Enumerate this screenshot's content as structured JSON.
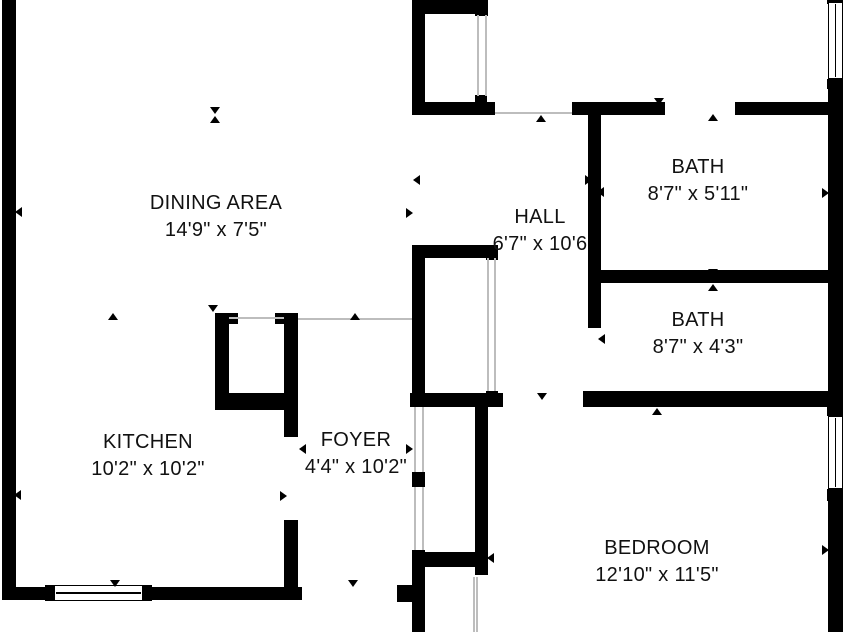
{
  "title": "Apartment floor plan",
  "colors": {
    "wall": "#000000",
    "opening_line": "#bdbdbd",
    "background": "#ffffff",
    "text": "#111111"
  },
  "rooms": [
    {
      "id": "dining",
      "name": "DINING AREA",
      "dims": "14'9\" x 7'5\"",
      "cx": 216,
      "cy": 217
    },
    {
      "id": "kitchen",
      "name": "KITCHEN",
      "dims": "10'2\" x 10'2\"",
      "cx": 148,
      "cy": 456
    },
    {
      "id": "foyer",
      "name": "FOYER",
      "dims": "4'4\" x 10'2\"",
      "cx": 356,
      "cy": 454
    },
    {
      "id": "hall",
      "name": "HALL",
      "dims": "6'7\" x 10'6",
      "cx": 540,
      "cy": 231
    },
    {
      "id": "bath-upper",
      "name": "BATH",
      "dims": "8'7\" x 5'11\"",
      "cx": 698,
      "cy": 181
    },
    {
      "id": "bath-lower",
      "name": "BATH",
      "dims": "8'7\" x 4'3\"",
      "cx": 698,
      "cy": 334
    },
    {
      "id": "bedroom",
      "name": "BEDROOM",
      "dims": "12'10\" x 11'5\"",
      "cx": 657,
      "cy": 562
    }
  ],
  "walls": [
    [
      2,
      0,
      14,
      600
    ],
    [
      2,
      587,
      300,
      13
    ],
    [
      412,
      0,
      76,
      14
    ],
    [
      412,
      0,
      13,
      115
    ],
    [
      412,
      102,
      83,
      13
    ],
    [
      475,
      0,
      13,
      16
    ],
    [
      475,
      95,
      12,
      8
    ],
    [
      572,
      102,
      93,
      13
    ],
    [
      735,
      102,
      93,
      13
    ],
    [
      828,
      0,
      15,
      632
    ],
    [
      588,
      115,
      13,
      213
    ],
    [
      600,
      270,
      228,
      13
    ],
    [
      583,
      391,
      245,
      16
    ],
    [
      410,
      393,
      93,
      14
    ],
    [
      412,
      245,
      86,
      13
    ],
    [
      412,
      245,
      13,
      162
    ],
    [
      486,
      245,
      12,
      15
    ],
    [
      486,
      391,
      12,
      16
    ],
    [
      215,
      313,
      14,
      97
    ],
    [
      229,
      313,
      9,
      11
    ],
    [
      275,
      313,
      9,
      11
    ],
    [
      284,
      313,
      14,
      124
    ],
    [
      215,
      393,
      83,
      17
    ],
    [
      284,
      520,
      14,
      67
    ],
    [
      412,
      472,
      13,
      15
    ],
    [
      412,
      550,
      13,
      82
    ],
    [
      425,
      552,
      52,
      15
    ],
    [
      397,
      585,
      15,
      17
    ],
    [
      475,
      400,
      13,
      175
    ]
  ],
  "opening_lines": [
    [
      229,
      317,
      55,
      2
    ],
    [
      298,
      318,
      114,
      2
    ],
    [
      495,
      112,
      77,
      2
    ],
    [
      477,
      15,
      2,
      81
    ],
    [
      485,
      15,
      2,
      81
    ],
    [
      487,
      258,
      2,
      133
    ],
    [
      494,
      258,
      2,
      133
    ],
    [
      414,
      407,
      2,
      65
    ],
    [
      422,
      407,
      2,
      65
    ],
    [
      414,
      487,
      2,
      63
    ],
    [
      422,
      487,
      2,
      63
    ],
    [
      473,
      577,
      2,
      55
    ],
    [
      476,
      577,
      2,
      55
    ]
  ],
  "windows": [
    {
      "orient": "h",
      "x": 54,
      "y": 585,
      "w": 89,
      "h": 16,
      "caps": [
        [
          45,
          585,
          9,
          16
        ],
        [
          143,
          585,
          9,
          16
        ]
      ]
    },
    {
      "orient": "v",
      "x": 828,
      "y": 2,
      "w": 15,
      "h": 77,
      "caps": [
        [
          827,
          0,
          16,
          4
        ],
        [
          827,
          79,
          16,
          10
        ]
      ]
    },
    {
      "orient": "v",
      "x": 828,
      "y": 416,
      "w": 15,
      "h": 73,
      "caps": [
        [
          827,
          405,
          16,
          11
        ],
        [
          827,
          489,
          16,
          12
        ]
      ]
    }
  ],
  "markers": [
    [
      215,
      110,
      "down"
    ],
    [
      215,
      119,
      "up"
    ],
    [
      18,
      212,
      "left"
    ],
    [
      416,
      180,
      "left"
    ],
    [
      409,
      213,
      "right"
    ],
    [
      113,
      316,
      "up"
    ],
    [
      213,
      308,
      "down"
    ],
    [
      355,
      316,
      "up"
    ],
    [
      115,
      583,
      "down"
    ],
    [
      353,
      583,
      "down"
    ],
    [
      17,
      495,
      "left"
    ],
    [
      283,
      496,
      "right"
    ],
    [
      302,
      449,
      "left"
    ],
    [
      409,
      449,
      "right"
    ],
    [
      541,
      118,
      "up"
    ],
    [
      542,
      396,
      "down"
    ],
    [
      588,
      180,
      "right"
    ],
    [
      600,
      192,
      "left"
    ],
    [
      601,
      339,
      "left"
    ],
    [
      825,
      193,
      "right"
    ],
    [
      659,
      101,
      "down"
    ],
    [
      713,
      117,
      "up"
    ],
    [
      713,
      272,
      "down"
    ],
    [
      713,
      287,
      "up"
    ],
    [
      714,
      394,
      "down"
    ],
    [
      657,
      411,
      "up"
    ],
    [
      825,
      550,
      "right"
    ],
    [
      490,
      558,
      "left"
    ]
  ]
}
